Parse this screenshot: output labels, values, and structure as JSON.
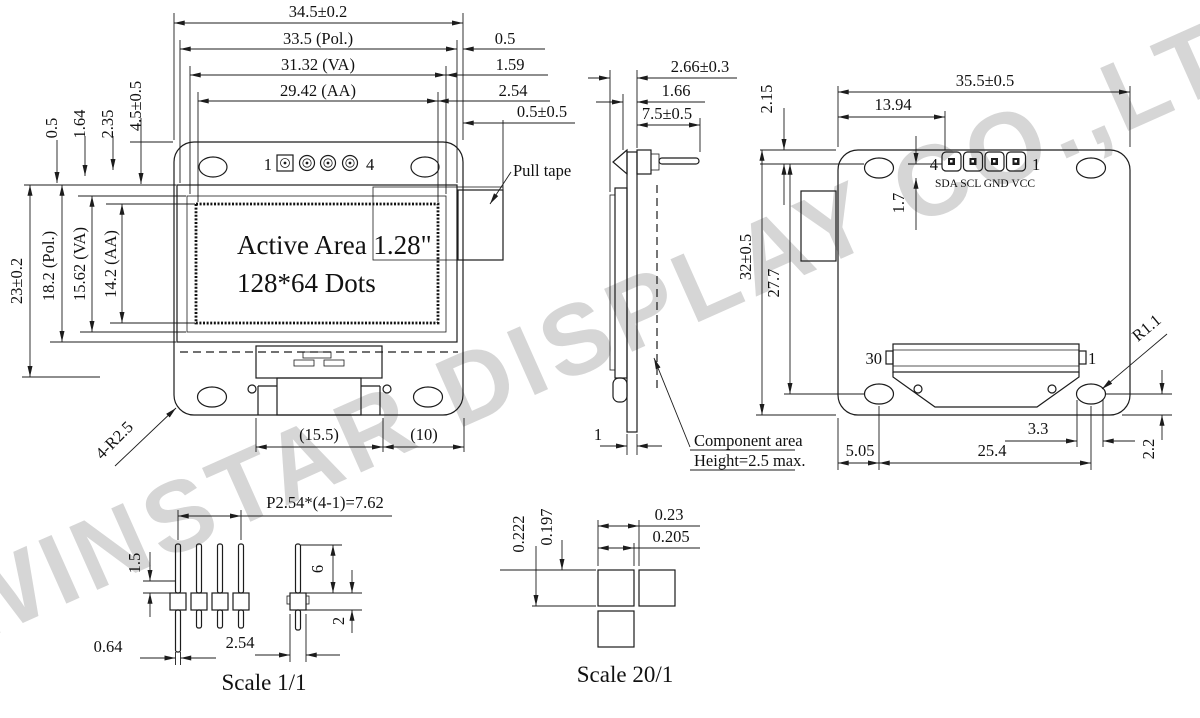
{
  "watermark": "WINSTAR DISPLAY CO.,LTD.",
  "front_view": {
    "top_dims": [
      "34.5±0.2",
      "33.5 (Pol.)",
      "31.32 (VA)",
      "29.42 (AA)"
    ],
    "right_dims": [
      "0.5",
      "1.59",
      "2.54",
      "0.5±0.5"
    ],
    "left_small_dims": [
      "0.5",
      "1.64",
      "2.35",
      "4.5±0.5"
    ],
    "left_dims": [
      "23±0.2",
      "18.2 (Pol.)",
      "15.62 (VA)",
      "14.2 (AA)"
    ],
    "pin_first": "1",
    "pin_last": "4",
    "active_area_line1": "Active Area 1.28\"",
    "active_area_line2": "128*64 Dots",
    "pull_tape_label": "Pull tape",
    "bottom_dims": [
      "(15.5)",
      "(10)"
    ],
    "corner_label": "4-R2.5"
  },
  "side_view": {
    "dim_total": "2.66±0.3",
    "dim_glass": "1.66",
    "dim_pin": "7.5±0.5",
    "dim_board": "1",
    "component_note_line1": "Component area",
    "component_note_line2": "Height=2.5 max."
  },
  "back_view": {
    "dim_width": "35.5±0.5",
    "dim_pin_offset": "13.94",
    "dim_edge": "2.15",
    "dim_pad": "1.7",
    "dim_height": "32±0.5",
    "dim_inner_height": "27.7",
    "pin_first": "4",
    "pin_last": "1",
    "pin_names": "SDA SCL GND VCC",
    "conn_first": "30",
    "conn_last": "1",
    "corner_label": "R1.1",
    "dim_hole_left": "5.05",
    "dim_hole_span": "25.4",
    "dim_hole_right": "3.3",
    "dim_hole_bottom": "2.2"
  },
  "header_detail": {
    "dim_pitch": "P2.54*(4-1)=7.62",
    "dim_tail": "1.5",
    "dim_length": "6",
    "dim_body": "2",
    "dim_pin_width": "0.64",
    "dim_spacing": "2.54",
    "caption": "Scale 1/1"
  },
  "dot_detail": {
    "dim_h_pitch": "0.23",
    "dim_h_dot": "0.205",
    "dim_v_pitch": "0.222",
    "dim_v_dot": "0.197",
    "caption": "Scale 20/1"
  },
  "colors": {
    "line": "#1c1c1c",
    "watermark": "#d6d6d6"
  }
}
